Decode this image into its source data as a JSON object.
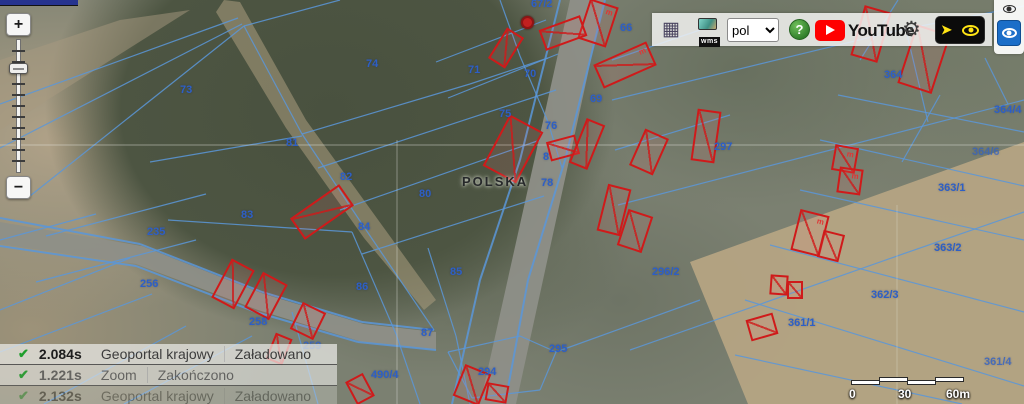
{
  "colors": {
    "parcel_line": "#5b97d9",
    "building_outline": "#cf1a1a",
    "parcel_label": "#2d5fc6",
    "accent_blue_button": "#1b6ec8",
    "youtube_red": "#ff0000",
    "status_check_green": "#1f9e2c"
  },
  "icons": {
    "legend-grid": "▦",
    "settings-gear": "⚙",
    "pan-arrow": "➤",
    "check": "✔"
  },
  "toolbar": {
    "wms_label": "wms",
    "language": {
      "value": "pol"
    },
    "help_label": "?",
    "youtube_label": "YouTube"
  },
  "zoom_control": {
    "zoom_in_label": "+",
    "zoom_out_label": "−"
  },
  "status_log": {
    "rows": [
      {
        "time": "2.084s",
        "source": "Geoportal krajowy",
        "status": "Załadowano",
        "opacity": 1
      },
      {
        "time": "1.221s",
        "source": "Zoom",
        "status": "Zakończono",
        "opacity": 0.85
      },
      {
        "time": "2.132s",
        "source": "Geoportal krajowy",
        "status": "Załadowano",
        "opacity": 0.38
      }
    ]
  },
  "scalebar": {
    "tick_labels": [
      {
        "text": "0",
        "x": 849
      },
      {
        "text": "30",
        "x": 898
      },
      {
        "text": "60m",
        "x": 946
      }
    ]
  },
  "map": {
    "country_label": "POLSKA",
    "parcel_line_color": "#5b97d9",
    "building_color": "#cf1a1a",
    "parcel_labels": [
      {
        "text": "67/2",
        "x": 531,
        "y": -2
      },
      {
        "text": "66",
        "x": 620,
        "y": 22
      },
      {
        "text": "71",
        "x": 468,
        "y": 64
      },
      {
        "text": "70",
        "x": 524,
        "y": 68
      },
      {
        "text": "69",
        "x": 590,
        "y": 93
      },
      {
        "text": "75",
        "x": 499,
        "y": 108
      },
      {
        "text": "76",
        "x": 545,
        "y": 120
      },
      {
        "text": "8",
        "x": 543,
        "y": 151
      },
      {
        "text": "78",
        "x": 541,
        "y": 177
      },
      {
        "text": "80",
        "x": 419,
        "y": 188
      },
      {
        "text": "73",
        "x": 180,
        "y": 84
      },
      {
        "text": "74",
        "x": 366,
        "y": 58
      },
      {
        "text": "81",
        "x": 286,
        "y": 137
      },
      {
        "text": "82",
        "x": 340,
        "y": 171
      },
      {
        "text": "83",
        "x": 241,
        "y": 209
      },
      {
        "text": "84",
        "x": 358,
        "y": 221
      },
      {
        "text": "85",
        "x": 450,
        "y": 266
      },
      {
        "text": "86",
        "x": 356,
        "y": 281
      },
      {
        "text": "87",
        "x": 421,
        "y": 327
      },
      {
        "text": "235",
        "x": 147,
        "y": 226
      },
      {
        "text": "256",
        "x": 140,
        "y": 278
      },
      {
        "text": "258",
        "x": 249,
        "y": 316
      },
      {
        "text": "259",
        "x": 303,
        "y": 340,
        "opacity": 0.8
      },
      {
        "text": "297",
        "x": 714,
        "y": 141
      },
      {
        "text": "296/2",
        "x": 652,
        "y": 266
      },
      {
        "text": "295",
        "x": 549,
        "y": 343
      },
      {
        "text": "294",
        "x": 478,
        "y": 366
      },
      {
        "text": "490/4",
        "x": 371,
        "y": 369
      },
      {
        "text": "364",
        "x": 884,
        "y": 69
      },
      {
        "text": "364/4",
        "x": 994,
        "y": 104
      },
      {
        "text": "364/6",
        "x": 972,
        "y": 146,
        "opacity": 0.7
      },
      {
        "text": "363/1",
        "x": 938,
        "y": 182
      },
      {
        "text": "363/2",
        "x": 934,
        "y": 242
      },
      {
        "text": "362/3",
        "x": 871,
        "y": 289
      },
      {
        "text": "361/1",
        "x": 788,
        "y": 317
      },
      {
        "text": "361/4",
        "x": 984,
        "y": 356,
        "opacity": 0.8
      }
    ],
    "buildings": [
      {
        "x": 583,
        "y": 2,
        "w": 30,
        "h": 42,
        "rot": 18,
        "mark": "m"
      },
      {
        "x": 541,
        "y": 22,
        "w": 44,
        "h": 22,
        "rot": -20
      },
      {
        "x": 496,
        "y": 30,
        "w": 20,
        "h": 36,
        "rot": 32
      },
      {
        "x": 596,
        "y": 52,
        "w": 58,
        "h": 26,
        "rot": -24,
        "mark": "m"
      },
      {
        "x": 494,
        "y": 120,
        "w": 38,
        "h": 58,
        "rot": 28
      },
      {
        "x": 548,
        "y": 138,
        "w": 30,
        "h": 20,
        "rot": -15
      },
      {
        "x": 577,
        "y": 120,
        "w": 20,
        "h": 48,
        "rot": 22
      },
      {
        "x": 636,
        "y": 132,
        "w": 26,
        "h": 40,
        "rot": 24
      },
      {
        "x": 694,
        "y": 110,
        "w": 24,
        "h": 52,
        "rot": 8
      },
      {
        "x": 602,
        "y": 186,
        "w": 24,
        "h": 48,
        "rot": 14
      },
      {
        "x": 622,
        "y": 212,
        "w": 26,
        "h": 38,
        "rot": 18
      },
      {
        "x": 292,
        "y": 199,
        "w": 60,
        "h": 26,
        "rot": -35
      },
      {
        "x": 220,
        "y": 262,
        "w": 26,
        "h": 44,
        "rot": 28
      },
      {
        "x": 252,
        "y": 276,
        "w": 28,
        "h": 40,
        "rot": 28
      },
      {
        "x": 295,
        "y": 306,
        "w": 26,
        "h": 30,
        "rot": 26
      },
      {
        "x": 270,
        "y": 335,
        "w": 18,
        "h": 28,
        "rot": 22
      },
      {
        "x": 350,
        "y": 376,
        "w": 20,
        "h": 26,
        "rot": -28
      },
      {
        "x": 458,
        "y": 368,
        "w": 28,
        "h": 34,
        "rot": 22
      },
      {
        "x": 486,
        "y": 384,
        "w": 22,
        "h": 18,
        "rot": 10
      },
      {
        "x": 857,
        "y": 8,
        "w": 28,
        "h": 52,
        "rot": 16
      },
      {
        "x": 906,
        "y": 28,
        "w": 36,
        "h": 62,
        "rot": 18,
        "mark": "m"
      },
      {
        "x": 833,
        "y": 146,
        "w": 24,
        "h": 26,
        "rot": 10,
        "mark": "m"
      },
      {
        "x": 838,
        "y": 168,
        "w": 24,
        "h": 26,
        "rot": 8,
        "mark": "m"
      },
      {
        "x": 795,
        "y": 212,
        "w": 30,
        "h": 42,
        "rot": 14,
        "mark": "m"
      },
      {
        "x": 820,
        "y": 232,
        "w": 22,
        "h": 28,
        "rot": 14
      },
      {
        "x": 770,
        "y": 275,
        "w": 18,
        "h": 20,
        "rot": 4
      },
      {
        "x": 787,
        "y": 281,
        "w": 16,
        "h": 18,
        "rot": 0
      },
      {
        "x": 748,
        "y": 316,
        "w": 28,
        "h": 22,
        "rot": -16
      }
    ],
    "markers": [
      {
        "x": 521,
        "y": 16,
        "w": 13,
        "h": 13
      }
    ],
    "areas": [
      {
        "name": "field-right-bottom",
        "points": "690,262 1024,142 1024,404 748,404",
        "fill": "#b5a483",
        "opacity": 0.95
      },
      {
        "name": "field-top-left",
        "points": "0,60 120,20 190,10 0,130",
        "fill": "#a89a80",
        "opacity": 0.5
      },
      {
        "name": "forest-track",
        "points": "224,0 240,2 306,120 384,228 436,300 424,310 364,238 286,128 216,12",
        "fill": "#a39779",
        "opacity": 0.6
      },
      {
        "name": "road-main",
        "points": "570,0 604,0 516,404 480,404",
        "fill": "#8e8f88",
        "opacity": 0.95
      },
      {
        "name": "road-left",
        "points": "0,222 142,246 264,294 364,324 436,332 436,350 362,342 258,310 136,264 0,244",
        "fill": "#8e8f88",
        "opacity": 0.95
      }
    ],
    "parcel_lines": [
      [
        0,
        104,
        238,
        18
      ],
      [
        0,
        148,
        242,
        24
      ],
      [
        30,
        196,
        244,
        26
      ],
      [
        0,
        240,
        96,
        214
      ],
      [
        46,
        236,
        206,
        194
      ],
      [
        36,
        282,
        196,
        240
      ],
      [
        0,
        310,
        130,
        258
      ],
      [
        0,
        352,
        152,
        294
      ],
      [
        44,
        404,
        186,
        326
      ],
      [
        124,
        404,
        252,
        336
      ],
      [
        0,
        218,
        140,
        244,
        1
      ],
      [
        140,
        244,
        262,
        292,
        1
      ],
      [
        262,
        292,
        362,
        322,
        1
      ],
      [
        362,
        322,
        434,
        330,
        1
      ],
      [
        0,
        246,
        136,
        266,
        1
      ],
      [
        136,
        266,
        256,
        312,
        1
      ],
      [
        256,
        312,
        358,
        342,
        1
      ],
      [
        358,
        342,
        436,
        350,
        1
      ],
      [
        244,
        26,
        302,
        134
      ],
      [
        302,
        134,
        362,
        224
      ],
      [
        362,
        224,
        434,
        330
      ],
      [
        244,
        26,
        340,
        0
      ],
      [
        150,
        162,
        302,
        136
      ],
      [
        168,
        220,
        352,
        232
      ],
      [
        302,
        134,
        470,
        84
      ],
      [
        470,
        84,
        548,
        58
      ],
      [
        318,
        168,
        556,
        90
      ],
      [
        340,
        210,
        540,
        140
      ],
      [
        362,
        254,
        544,
        196
      ],
      [
        352,
        232,
        396,
        334
      ],
      [
        396,
        334,
        420,
        404
      ],
      [
        428,
        248,
        456,
        336
      ],
      [
        456,
        336,
        470,
        404
      ],
      [
        292,
        312,
        318,
        404
      ],
      [
        436,
        62,
        546,
        20
      ],
      [
        448,
        98,
        558,
        54
      ],
      [
        500,
        0,
        520,
        56
      ],
      [
        520,
        56,
        548,
        122
      ],
      [
        548,
        122,
        562,
        168
      ],
      [
        560,
        0,
        520,
        160,
        1
      ],
      [
        520,
        160,
        480,
        280,
        1
      ],
      [
        480,
        280,
        452,
        404,
        1
      ],
      [
        605,
        0,
        565,
        160,
        1
      ],
      [
        565,
        160,
        528,
        280,
        1
      ],
      [
        528,
        280,
        505,
        404,
        1
      ],
      [
        612,
        60,
        700,
        30
      ],
      [
        615,
        150,
        730,
        115
      ],
      [
        612,
        100,
        900,
        30
      ],
      [
        900,
        30,
        1024,
        6
      ],
      [
        618,
        205,
        1024,
        100
      ],
      [
        630,
        350,
        900,
        255
      ],
      [
        900,
        255,
        1024,
        212
      ],
      [
        838,
        95,
        1024,
        132
      ],
      [
        820,
        140,
        1024,
        186
      ],
      [
        800,
        190,
        1024,
        240
      ],
      [
        770,
        245,
        1024,
        312
      ],
      [
        745,
        300,
        1024,
        386
      ],
      [
        735,
        355,
        962,
        404
      ],
      [
        860,
        60,
        898,
        0
      ],
      [
        928,
        122,
        906,
        30
      ],
      [
        985,
        58,
        1008,
        104
      ],
      [
        902,
        162,
        940,
        95
      ],
      [
        448,
        352,
        520,
        336
      ],
      [
        520,
        336,
        556,
        352
      ],
      [
        556,
        352,
        540,
        390
      ],
      [
        540,
        390,
        472,
        398
      ],
      [
        472,
        398,
        448,
        352
      ],
      [
        556,
        352,
        700,
        300
      ]
    ],
    "seams": [
      [
        0,
        145,
        1024,
        145,
        0.45
      ],
      [
        397,
        140,
        397,
        404,
        0.4
      ],
      [
        897,
        205,
        897,
        404,
        0.3
      ]
    ]
  }
}
